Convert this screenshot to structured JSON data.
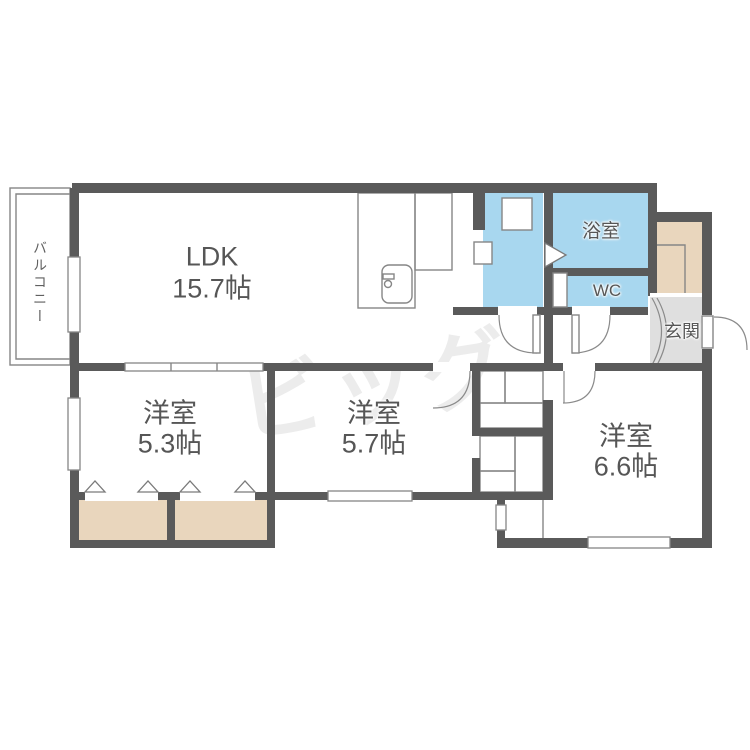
{
  "floorplan": {
    "rooms": {
      "ldk": {
        "name": "LDK",
        "size": "15.7帖"
      },
      "bedroom_53": {
        "name": "洋室",
        "size": "5.3帖"
      },
      "bedroom_57": {
        "name": "洋室",
        "size": "5.7帖"
      },
      "bedroom_66": {
        "name": "洋室",
        "size": "6.6帖"
      },
      "bathroom": {
        "name": "浴室"
      },
      "toilet": {
        "name": "WC"
      },
      "entrance": {
        "name": "玄関"
      },
      "balcony": {
        "name": "バルコニー"
      }
    },
    "watermark_logo_text": "ビッグ",
    "colors": {
      "wall": "#5a5a5a",
      "water_area": "#a8d7ef",
      "closet": "#e9d6bd",
      "entrance_floor": "#dfdfdf",
      "thin_line": "#868686"
    }
  }
}
